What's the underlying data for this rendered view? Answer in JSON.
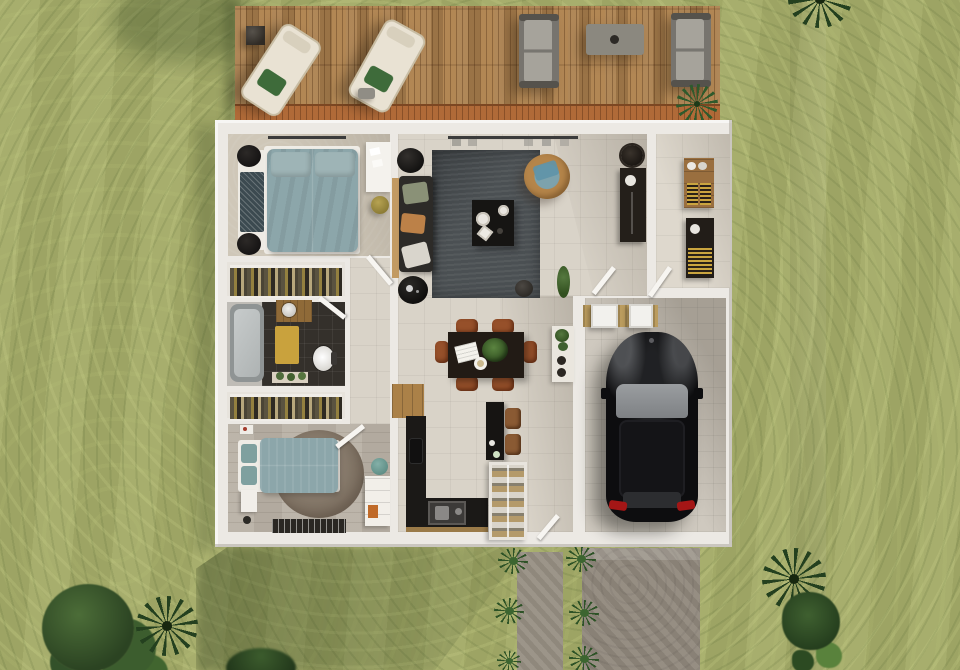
{
  "scene": {
    "type": "3d-architectural-floor-plan-render",
    "view": "top-down aerial",
    "visible_text": "none",
    "environment": "lawn with trees, concrete driveway and walkway, wooden terrace"
  },
  "palette": {
    "grass_base": "#a4ab68",
    "grass_light": "#b7bd7c",
    "grass_dark": "#7e8c4f",
    "tree_dark": "#2b4322",
    "deck_wood": "#a97e4d",
    "deck_edge": "#b06a38",
    "house_wall": "#ece9e4",
    "floor_tile": "#d9d3c8",
    "carpet": "#cfc7b8",
    "wood_floor": "#b9b1a5",
    "bathroom_tile": "#34302b",
    "living_rug": "#4b5053",
    "round_rug": "#8b7d6e",
    "bed_duvet_teal": "#8ca6aa",
    "sofa_dark": "#2d2b28",
    "dining_table": "#221b15",
    "chair_rust": "#96502a",
    "kitchen_counter": "#1b1917",
    "car_black": "#0d0d0f",
    "windshield_gray": "#8f9294",
    "taillight_red": "#a41616",
    "concrete": "#90887c",
    "garage_mat_tan": "#bb9c5e",
    "vanity_wood": "#8f6a38",
    "bath_mat_yellow": "#c9a23d",
    "lounger_cream": "#e9e2d3",
    "lounger_pillow_green": "#3e6b3a",
    "outdoor_sofa_gray": "#a6a39b"
  },
  "outdoor": {
    "deck": {
      "name": "wooden terrace",
      "furniture": [
        "lounge-chair",
        "lounge-chair",
        "round-side-stool",
        "serving-tray",
        "outdoor-sofa",
        "outdoor-sofa",
        "outdoor-coffee-table",
        "potted-palm"
      ]
    },
    "driveway": {
      "strips": [
        "walkway-narrow",
        "driveway-wide"
      ],
      "grass_tufts": 6
    },
    "vegetation": [
      "tree-cluster-bottom-left",
      "palm-bottom-left",
      "palm-bottom-right",
      "fern-bottom-right",
      "bush-bottom-center",
      "palm-frond-top-right",
      "tree-shadow-top-left"
    ]
  },
  "house": {
    "rooms": [
      {
        "name": "bedroom-1",
        "furniture": [
          "double-bed-teal",
          "bench-with-throw",
          "round-nightstand",
          "round-nightstand",
          "desk",
          "pouf-olive",
          "curtain-rail"
        ]
      },
      {
        "name": "wardrobe-closet-1",
        "furniture": [
          "hanging-clothes-rail"
        ]
      },
      {
        "name": "bathroom",
        "furniture": [
          "bathtub",
          "wood-vanity-with-sink",
          "toilet",
          "yellow-bath-mat",
          "bench-with-plants"
        ]
      },
      {
        "name": "wardrobe-closet-2",
        "furniture": [
          "hanging-clothes-rail"
        ]
      },
      {
        "name": "bedroom-2",
        "furniture": [
          "double-bed-teal",
          "round-rug",
          "nightstand",
          "pouf-teal",
          "dresser-white",
          "window-vent",
          "wall-art"
        ]
      },
      {
        "name": "hallway",
        "furniture": [
          "door-leaf",
          "door-leaf"
        ]
      },
      {
        "name": "living-room",
        "furniture": [
          "area-rug-dark",
          "sofa-dark",
          "coffee-table-black",
          "rattan-armchair",
          "round-side-table",
          "round-side-table",
          "console-strip",
          "pouf-dark",
          "floor-plant",
          "curtain-rail"
        ]
      },
      {
        "name": "dining-area",
        "furniture": [
          "dining-table-dark",
          "chair-rust-x6",
          "plant-centerpiece",
          "open-book",
          "plate",
          "white-console-with-plants"
        ]
      },
      {
        "name": "kitchen",
        "furniture": [
          "wood-cabinet",
          "l-shaped-black-counter",
          "sink",
          "stove",
          "island-black",
          "bar-stool",
          "bar-stool",
          "glass-pantry-cabinet"
        ]
      },
      {
        "name": "entry-hall",
        "furniture": [
          "round-mirror",
          "dark-console",
          "door-leaf"
        ]
      },
      {
        "name": "mudroom",
        "furniture": [
          "wood-shelf-with-baskets",
          "dark-cabinet-with-basket",
          "door-leaf"
        ]
      },
      {
        "name": "garage",
        "furniture": [
          "black-car",
          "storage-box",
          "storage-box",
          "tan-mat"
        ]
      }
    ]
  }
}
